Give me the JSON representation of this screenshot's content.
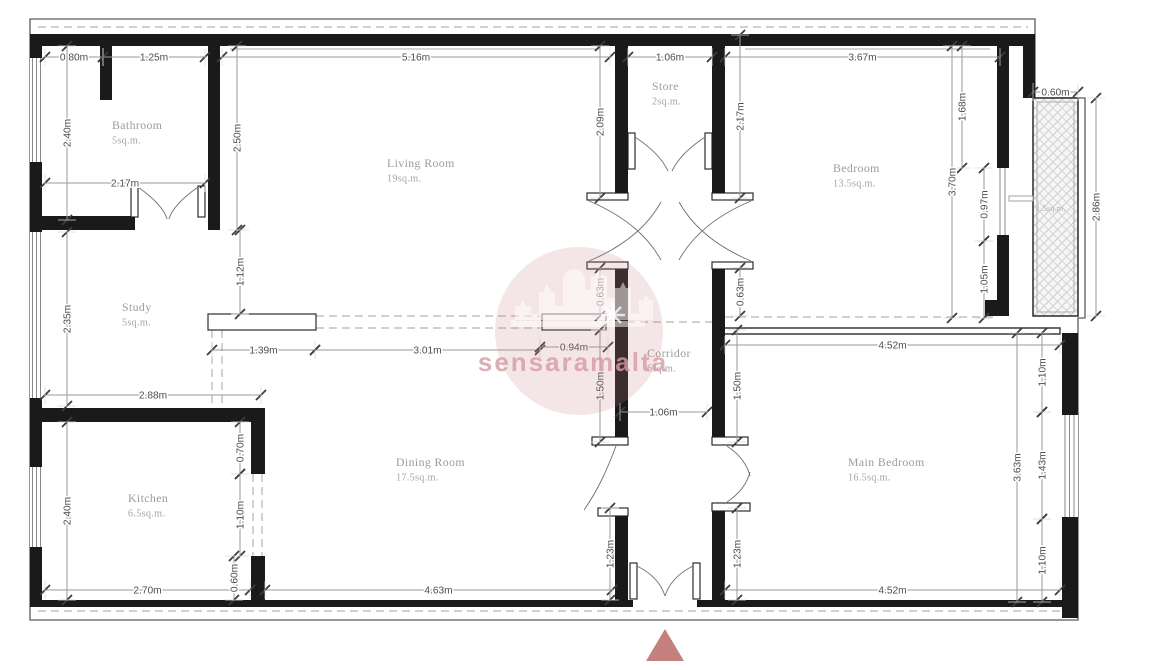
{
  "watermark": {
    "text": "sensaramalta"
  },
  "shaft": {
    "area": "1.5sq.m."
  },
  "rooms": [
    {
      "name": "Bathroom",
      "area": "5sq.m.",
      "x": 112,
      "y": 129
    },
    {
      "name": "Living Room",
      "area": "19sq.m.",
      "x": 387,
      "y": 167
    },
    {
      "name": "Store",
      "area": "2sq.m.",
      "x": 652,
      "y": 90
    },
    {
      "name": "Bedroom",
      "area": "13.5sq.m.",
      "x": 833,
      "y": 172
    },
    {
      "name": "Study",
      "area": "5sq.m.",
      "x": 122,
      "y": 311
    },
    {
      "name": "Corridor",
      "area": "6sq.m.",
      "x": 647,
      "y": 357
    },
    {
      "name": "Kitchen",
      "area": "6.5sq.m.",
      "x": 128,
      "y": 502
    },
    {
      "name": "Dining Room",
      "area": "17.5sq.m.",
      "x": 396,
      "y": 466
    },
    {
      "name": "Main Bedroom",
      "area": "16.5sq.m.",
      "x": 848,
      "y": 466
    }
  ],
  "dimensions": [
    {
      "label": "0.80m",
      "x1": 45,
      "y1": 57,
      "x2": 103,
      "y2": 57
    },
    {
      "label": "1.25m",
      "x1": 103,
      "y1": 57,
      "x2": 205,
      "y2": 57
    },
    {
      "label": "5.16m",
      "x1": 222,
      "y1": 57,
      "x2": 610,
      "y2": 57
    },
    {
      "label": "1.06m",
      "x1": 628,
      "y1": 57,
      "x2": 712,
      "y2": 57
    },
    {
      "label": "3.67m",
      "x1": 725,
      "y1": 57,
      "x2": 1000,
      "y2": 57
    },
    {
      "label": "0.60m",
      "x1": 1033,
      "y1": 92,
      "x2": 1078,
      "y2": 92
    },
    {
      "label": "2.17m",
      "x1": 45,
      "y1": 183,
      "x2": 205,
      "y2": 183
    },
    {
      "label": "1.39m",
      "x1": 212,
      "y1": 350,
      "x2": 315,
      "y2": 350
    },
    {
      "label": "3.01m",
      "x1": 315,
      "y1": 350,
      "x2": 540,
      "y2": 350
    },
    {
      "label": "0.94m",
      "x1": 540,
      "y1": 347,
      "x2": 608,
      "y2": 347
    },
    {
      "label": "4.52m",
      "x1": 725,
      "y1": 345,
      "x2": 1060,
      "y2": 345
    },
    {
      "label": "2.88m",
      "x1": 45,
      "y1": 395,
      "x2": 261,
      "y2": 395
    },
    {
      "label": "1.06m",
      "x1": 620,
      "y1": 412,
      "x2": 707,
      "y2": 412
    },
    {
      "label": "2.70m",
      "x1": 45,
      "y1": 590,
      "x2": 250,
      "y2": 590
    },
    {
      "label": "4.63m",
      "x1": 265,
      "y1": 590,
      "x2": 612,
      "y2": 590
    },
    {
      "label": "4.52m",
      "x1": 725,
      "y1": 590,
      "x2": 1060,
      "y2": 590
    },
    {
      "label": "2.40m",
      "x1": 67,
      "y1": 46,
      "x2": 67,
      "y2": 220
    },
    {
      "label": "2.50m",
      "x1": 237,
      "y1": 46,
      "x2": 237,
      "y2": 230
    },
    {
      "label": "2.09m",
      "x1": 600,
      "y1": 46,
      "x2": 600,
      "y2": 198
    },
    {
      "label": "2.17m",
      "x1": 740,
      "y1": 35,
      "x2": 740,
      "y2": 198
    },
    {
      "label": "1.68m",
      "x1": 962,
      "y1": 46,
      "x2": 962,
      "y2": 168
    },
    {
      "label": "3.70m",
      "x1": 952,
      "y1": 46,
      "x2": 952,
      "y2": 318
    },
    {
      "label": "0.97m",
      "x1": 984,
      "y1": 168,
      "x2": 984,
      "y2": 241
    },
    {
      "label": "1.05m",
      "x1": 984,
      "y1": 241,
      "x2": 984,
      "y2": 318
    },
    {
      "label": "2.86m",
      "x1": 1096,
      "y1": 98,
      "x2": 1096,
      "y2": 316
    },
    {
      "label": "2.35m",
      "x1": 67,
      "y1": 232,
      "x2": 67,
      "y2": 406
    },
    {
      "label": "1.12m",
      "x1": 240,
      "y1": 230,
      "x2": 240,
      "y2": 314
    },
    {
      "label": "0.63m",
      "x1": 600,
      "y1": 268,
      "x2": 600,
      "y2": 316
    },
    {
      "label": "0.63m",
      "x1": 740,
      "y1": 268,
      "x2": 740,
      "y2": 316
    },
    {
      "label": "1.50m",
      "x1": 600,
      "y1": 330,
      "x2": 600,
      "y2": 442
    },
    {
      "label": "1.50m",
      "x1": 737,
      "y1": 330,
      "x2": 737,
      "y2": 442
    },
    {
      "label": "2.40m",
      "x1": 67,
      "y1": 422,
      "x2": 67,
      "y2": 600
    },
    {
      "label": "0.70m",
      "x1": 240,
      "y1": 422,
      "x2": 240,
      "y2": 474
    },
    {
      "label": "1.10m",
      "x1": 240,
      "y1": 474,
      "x2": 240,
      "y2": 556
    },
    {
      "label": "0.60m",
      "x1": 234,
      "y1": 556,
      "x2": 234,
      "y2": 600
    },
    {
      "label": "1.23m",
      "x1": 610,
      "y1": 508,
      "x2": 610,
      "y2": 600
    },
    {
      "label": "1.23m",
      "x1": 737,
      "y1": 508,
      "x2": 737,
      "y2": 600
    },
    {
      "label": "3.63m",
      "x1": 1017,
      "y1": 333,
      "x2": 1017,
      "y2": 602
    },
    {
      "label": "1.10m",
      "x1": 1042,
      "y1": 333,
      "x2": 1042,
      "y2": 412
    },
    {
      "label": "1.43m",
      "x1": 1042,
      "y1": 412,
      "x2": 1042,
      "y2": 519
    },
    {
      "label": "1.10m",
      "x1": 1042,
      "y1": 519,
      "x2": 1042,
      "y2": 602
    }
  ]
}
